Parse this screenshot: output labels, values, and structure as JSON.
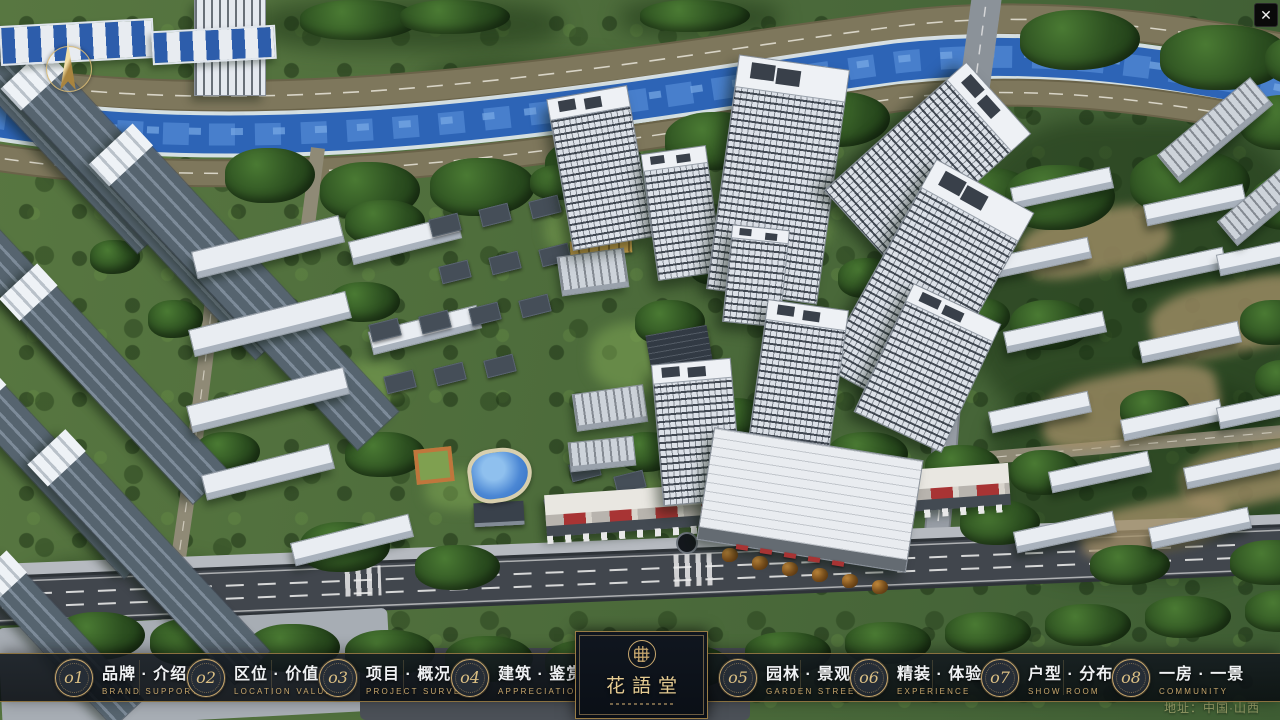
{
  "window": {
    "close_glyph": "✕"
  },
  "colors": {
    "gold": "#C9A86E",
    "gold_bright": "#E6CC92",
    "bar_background": "rgba(10,14,19,0.88)",
    "river_blue": "#2D64B6",
    "shop_red": "#A83434"
  },
  "nav": {
    "items": [
      {
        "num": "o1",
        "zh": "品牌 · 介绍",
        "en": "BRAND SUPPORT"
      },
      {
        "num": "o2",
        "zh": "区位 · 价值",
        "en": "LOCATION VALUE"
      },
      {
        "num": "o3",
        "zh": "项目 · 概况",
        "en": "PROJECT SURVEY"
      },
      {
        "num": "o4",
        "zh": "建筑 · 鉴赏",
        "en": "APPRECIATION"
      },
      {
        "num": "o5",
        "zh": "园林 · 景观",
        "en": "GARDEN STREET"
      },
      {
        "num": "o6",
        "zh": "精装 · 体验",
        "en": "EXPERIENCE"
      },
      {
        "num": "o7",
        "zh": "户型 · 分布",
        "en": "SHOW ROOM"
      },
      {
        "num": "o8",
        "zh": "一房 · 一景",
        "en": "COMMUNITY"
      }
    ]
  },
  "logo": {
    "title": "花語堂"
  },
  "footer": {
    "address": "地址：中国·山西"
  }
}
